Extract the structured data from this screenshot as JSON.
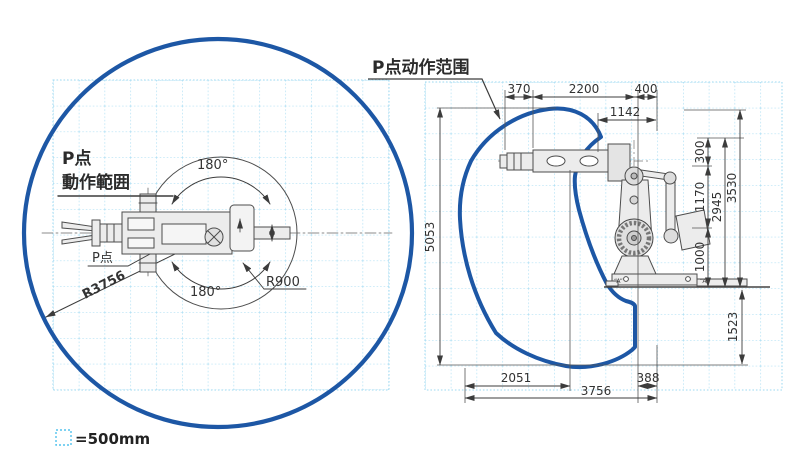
{
  "colors": {
    "envelope_blue": "#1d57a5",
    "grid_blue": "#9ed9f2",
    "line_dark": "#3c3c3c"
  },
  "legend": {
    "label": "=500mm"
  },
  "left_view": {
    "title_line1": "P点",
    "title_line2": "動作範囲",
    "p_point_label": "P点",
    "radius_outer": "R3756",
    "radius_inner": "R900",
    "angle_top": "180°",
    "angle_bottom": "180°"
  },
  "right_view": {
    "title": "P点动作范围",
    "marker_a_left": "“A”",
    "marker_a_right": "“A”",
    "dims": {
      "d370": "370",
      "d2200": "2200",
      "d400": "400",
      "d1142": "1142",
      "d5053": "5053",
      "d300": "300",
      "d1170": "1170",
      "d2945": "2945",
      "d3530": "3530",
      "d1000": "1000",
      "d1523": "1523",
      "d2051": "2051",
      "d3756": "3756",
      "d388": "388"
    }
  }
}
